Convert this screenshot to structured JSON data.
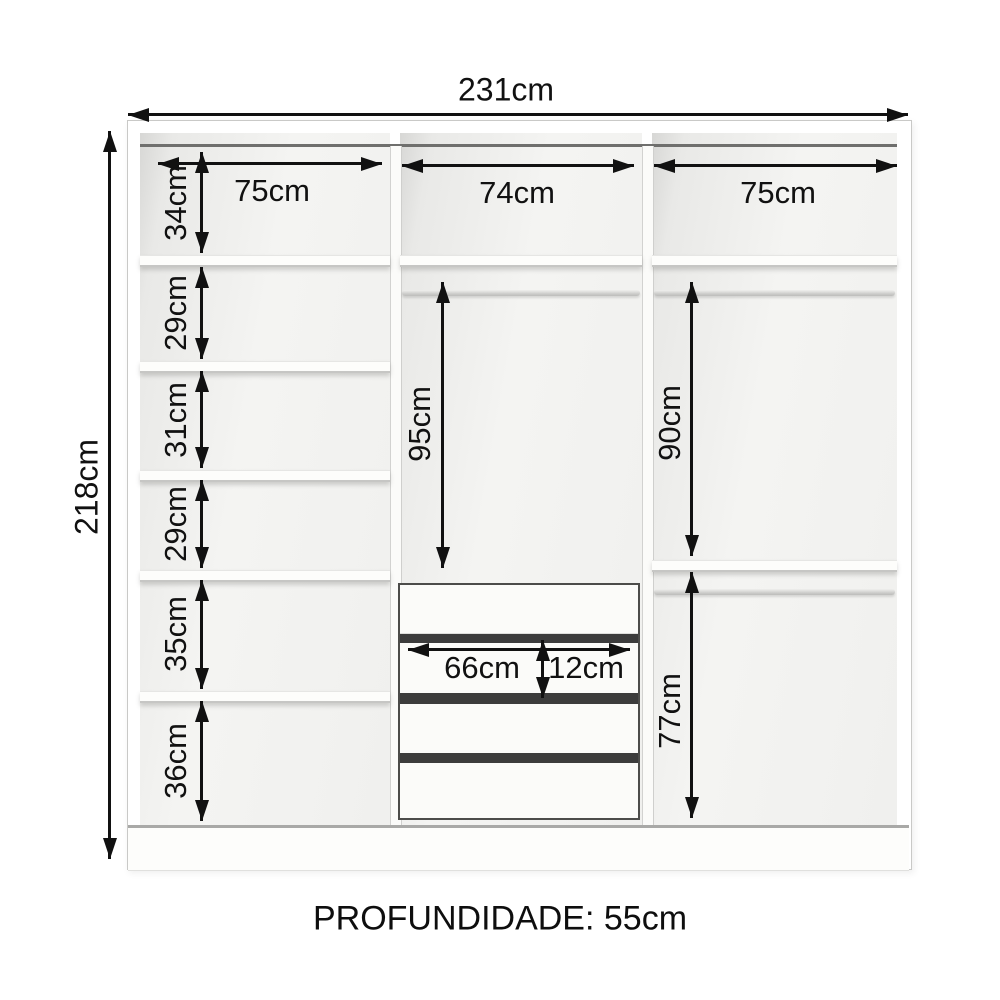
{
  "palette": {
    "ink": "#111111",
    "carcass_white": "#ffffff",
    "interior_gray": "#ededeb",
    "drawer_gap_dark": "#3c3c3c"
  },
  "labels": {
    "total_width": "231cm",
    "total_height": "218cm",
    "depth": "PROFUNDIDADE: 55cm",
    "col_left_width": "75cm",
    "col_mid_width": "74cm",
    "col_right_width": "75cm",
    "left_sections": [
      "34cm",
      "29cm",
      "31cm",
      "29cm",
      "35cm",
      "36cm"
    ],
    "mid_hanging_height": "95cm",
    "drawer_width": "66cm",
    "drawer_face_height": "12cm",
    "right_hanging_top_height": "90cm",
    "right_hanging_bottom_height": "77cm"
  }
}
